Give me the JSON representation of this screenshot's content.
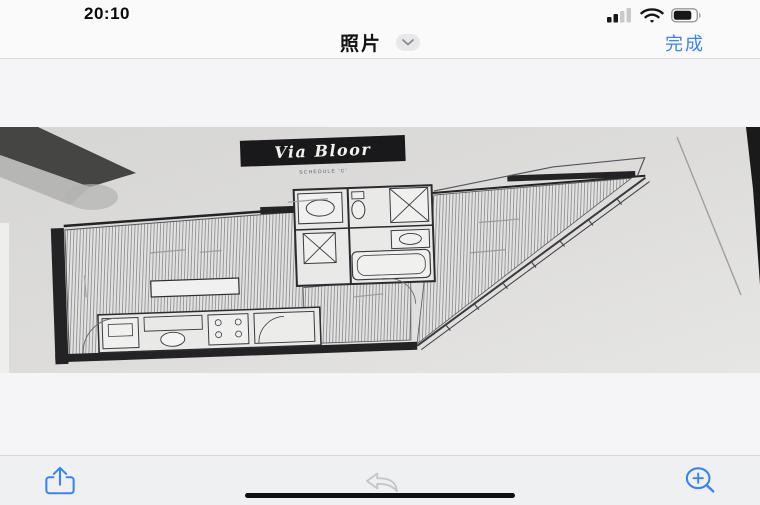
{
  "status_bar": {
    "time": "20:10",
    "cellular": {
      "filled_bars": 2,
      "total_bars": 4
    },
    "wifi_icon": "wifi-icon",
    "battery": {
      "level_percent": 75
    }
  },
  "nav_bar": {
    "title": "照片",
    "title_dropdown_icon": "chevron-down-icon",
    "done_label": "完成"
  },
  "photo": {
    "type": "floor-plan-photo",
    "plan_label": "Via Bloor",
    "plan_sublabel": "SCHEDULE 'C'"
  },
  "toolbar": {
    "items": [
      {
        "icon": "share-icon",
        "enabled": true
      },
      {
        "icon": "reply-icon",
        "enabled": false
      },
      {
        "icon": "zoom-in-icon",
        "enabled": true
      }
    ]
  },
  "colors": {
    "accent_blue": "#3b82f7",
    "toolbar_bg": "#eff0f1",
    "content_bg": "#f5f5f7",
    "plan_label_bg": "#19191b"
  }
}
